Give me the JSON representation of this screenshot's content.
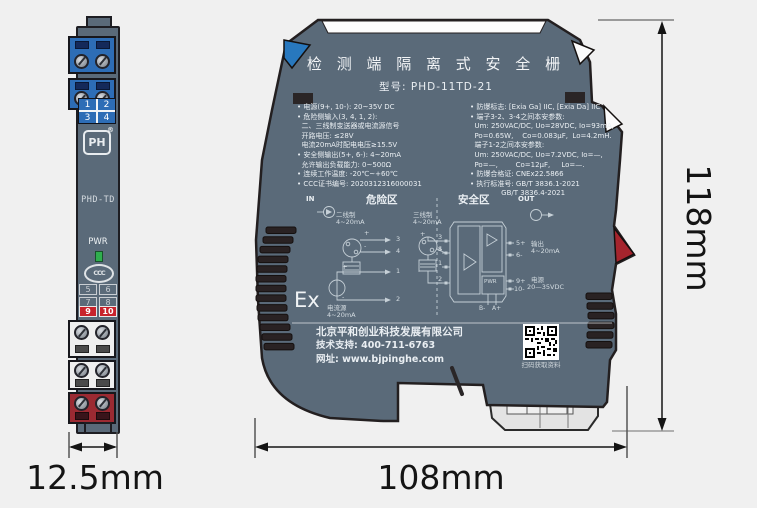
{
  "front_view": {
    "plate_top": [
      "1",
      "2",
      "3",
      "4"
    ],
    "logo_text": "PH",
    "logo_reg": "®",
    "model": "PHD-TD",
    "pwr_label": "PWR",
    "cert_mark": "CCC",
    "plate_mid": [
      "5",
      "6",
      "7",
      "8"
    ],
    "plate_red": [
      "9",
      "10"
    ]
  },
  "side_view": {
    "title": "检 测 端 隔 离 式 安 全 栅",
    "model_label": "型号: PHD-11TD-21",
    "specs_left": [
      "• 电源(9+, 10-): 20~35V DC",
      "• 危险侧输入(3, 4, 1, 2):",
      "  二、三线制变送器或电流源信号",
      "  开路电压: ≤28V",
      "  电流20mA时配电电压≥15.5V",
      "• 安全侧输出(5+, 6-): 4~20mA",
      "  允许输出负载能力: 0~500Ω",
      "• 连续工作温度: -20℃~+60℃",
      "• CCC证书编号: 2020312316000031"
    ],
    "specs_right": [
      "• 防爆标志: [Exia Ga] IIC, [Exia Da] IIC",
      "• 端子3-2、3-4之间本安参数:",
      "  Um: 250VAC/DC, Uo=28VDC, Io=93mA,",
      "  Po=0.65W,    Co=0.083μF,  Lo=4.2mH.",
      "  端子1-2之间本安参数:",
      "  Um: 250VAC/DC, Uo=7.2VDC, Io=—,",
      "  Po=—,        Co=12μF,     Lo=—.",
      "• 防爆合格证: CNEx22.5866",
      "• 执行标准号: GB/T 3836.1-2021",
      "              GB/T 3836.4-2021"
    ],
    "diagram": {
      "in_label": "IN",
      "out_label": "OUT",
      "hazard_zone": "危险区",
      "safe_zone": "安全区",
      "two_wire_name": "二线制",
      "two_wire_range": "4~20mA",
      "three_wire_name": "三线制",
      "three_wire_range": "4~20mA",
      "current_source_name": "电流源",
      "current_source_range": "4~20mA",
      "sign_plus": "+",
      "sign_minus": "-",
      "sign_s": "S",
      "mini_terminals": [
        "3",
        "4",
        "1",
        "2"
      ],
      "block_terminals_left": [
        "3",
        "4",
        "1",
        "2"
      ],
      "block_terminals_right": [
        "5+",
        "6-",
        "9+",
        "10-"
      ],
      "output_label": "输出",
      "output_range": "4~20mA",
      "power_label": "电源",
      "power_range": "20—35VDC",
      "pwr_box": "PWR",
      "pin_b": "B-",
      "pin_a": "A+",
      "ex_mark": "Ex"
    },
    "footer": {
      "company": "北京平和创业科技发展有限公司",
      "support": "技术支持: 400-711-6763",
      "website": "网址: www.bjpinghe.com",
      "qr_caption": "扫码获取资料"
    }
  },
  "dimensions": {
    "front_width": "12.5mm",
    "side_width": "108mm",
    "height": "118mm"
  },
  "colors": {
    "body": "#5a6a79",
    "accent_blue": "#2d6db6",
    "accent_red": "#9b2a32",
    "led_green": "#2fae4e",
    "background": "#f0f0f0"
  }
}
